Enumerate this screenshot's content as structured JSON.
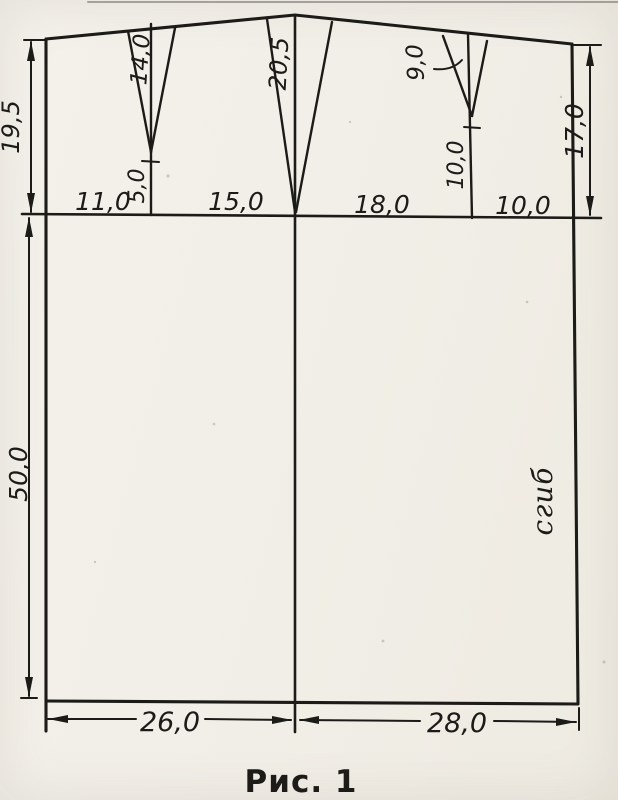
{
  "figure": {
    "caption": "Рис. 1",
    "fold_label": "сгиб"
  },
  "labels": {
    "waist_to_hip_left": "19,5",
    "hip_to_hem_left": "50,0",
    "waist_to_hip_right": "17,0",
    "hip_segment_1": "11,0",
    "hip_segment_2": "15,0",
    "hip_segment_3": "18,0",
    "hip_segment_4": "10,0",
    "dart_back_depth": "14,0",
    "dart_back_point_to_hip": "5,0",
    "dart_side_depth": "20,5",
    "dart_front_depth": "9,0",
    "dart_front_point_to_hip": "10,0",
    "hem_back_width": "26,0",
    "hem_front_width": "28,0"
  },
  "colors": {
    "ink": "#1d1b18",
    "paper": "#f1eee7"
  }
}
